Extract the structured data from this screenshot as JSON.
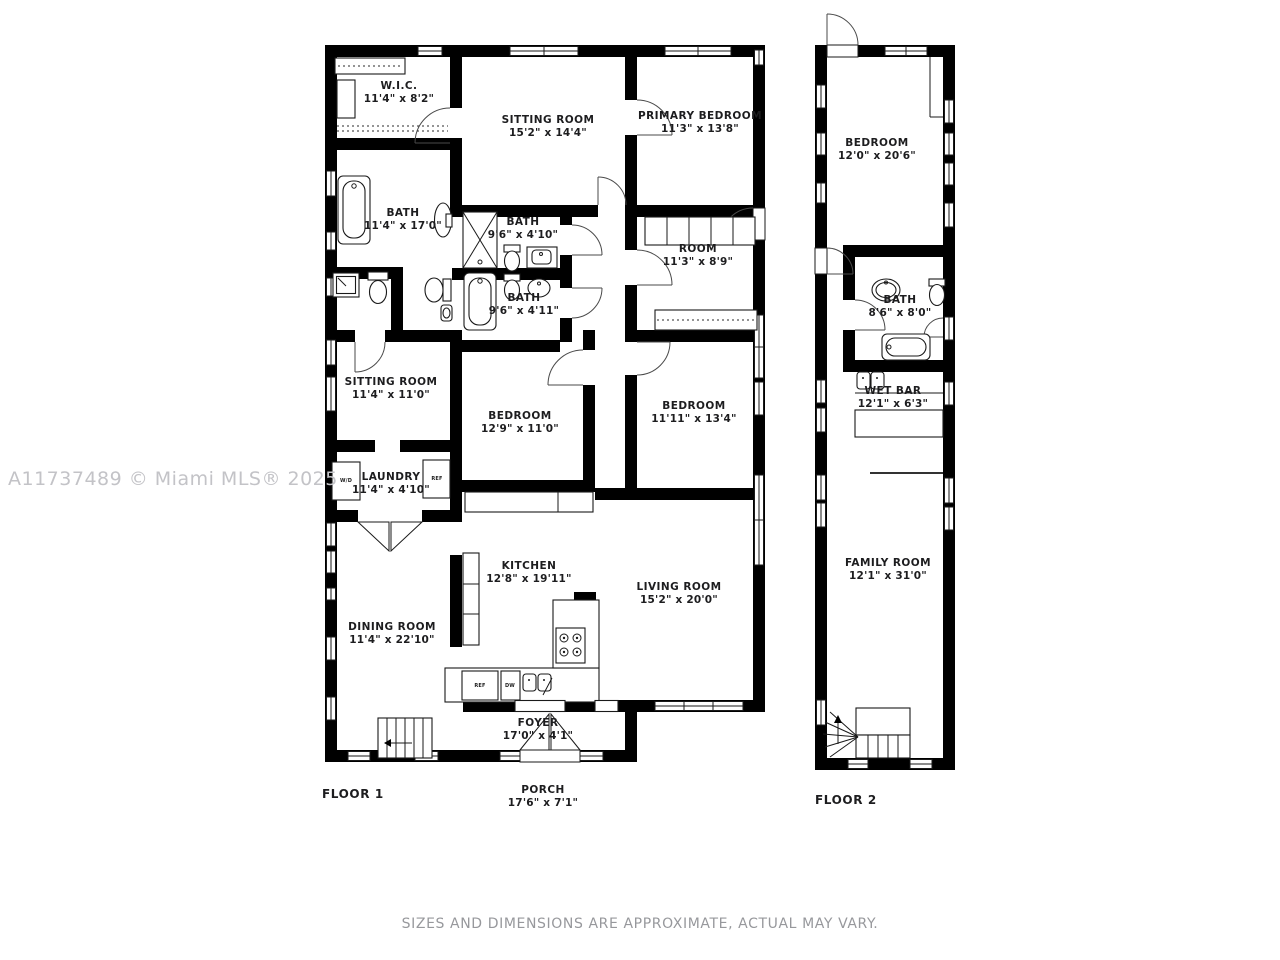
{
  "watermark": "A11737489 © Miami MLS® 2025",
  "disclaimer": "SIZES AND DIMENSIONS ARE APPROXIMATE, ACTUAL MAY VARY.",
  "colors": {
    "wall": "#000000",
    "label": "#1d1d1f",
    "watermark": "#c3c3c7",
    "disclaimer": "#97989c"
  },
  "floor1": {
    "label": "FLOOR 1",
    "rooms": [
      {
        "name": "W.I.C.",
        "dims": "11'4\" x 8'2\""
      },
      {
        "name": "SITTING ROOM",
        "dims": "15'2\" x 14'4\""
      },
      {
        "name": "PRIMARY BEDROOM",
        "dims": "11'3\" x 13'8\""
      },
      {
        "name": "BATH",
        "dims": "11'4\" x 17'0\""
      },
      {
        "name": "BATH",
        "dims": "9'6\" x 4'10\""
      },
      {
        "name": "ROOM",
        "dims": "11'3\" x 8'9\""
      },
      {
        "name": "BATH",
        "dims": "9'6\" x 4'11\""
      },
      {
        "name": "SITTING ROOM",
        "dims": "11'4\" x 11'0\""
      },
      {
        "name": "BEDROOM",
        "dims": "12'9\" x 11'0\""
      },
      {
        "name": "BEDROOM",
        "dims": "11'11\" x 13'4\""
      },
      {
        "name": "LAUNDRY",
        "dims": "11'4\" x 4'10\""
      },
      {
        "name": "KITCHEN",
        "dims": "12'8\" x 19'11\""
      },
      {
        "name": "LIVING ROOM",
        "dims": "15'2\" x 20'0\""
      },
      {
        "name": "DINING ROOM",
        "dims": "11'4\" x 22'10\""
      },
      {
        "name": "FOYER",
        "dims": "17'0\" x 4'1\""
      },
      {
        "name": "PORCH",
        "dims": "17'6\" x 7'1\""
      }
    ],
    "appliances": {
      "kitchen_ref": "REF",
      "kitchen_dw": "DW",
      "laundry_wd": "W/D",
      "laundry_ref": "REF"
    }
  },
  "floor2": {
    "label": "FLOOR 2",
    "rooms": [
      {
        "name": "BEDROOM",
        "dims": "12'0\" x 20'6\""
      },
      {
        "name": "BATH",
        "dims": "8'6\" x 8'0\""
      },
      {
        "name": "WET BAR",
        "dims": "12'1\" x 6'3\""
      },
      {
        "name": "FAMILY ROOM",
        "dims": "12'1\" x 31'0\""
      }
    ]
  }
}
